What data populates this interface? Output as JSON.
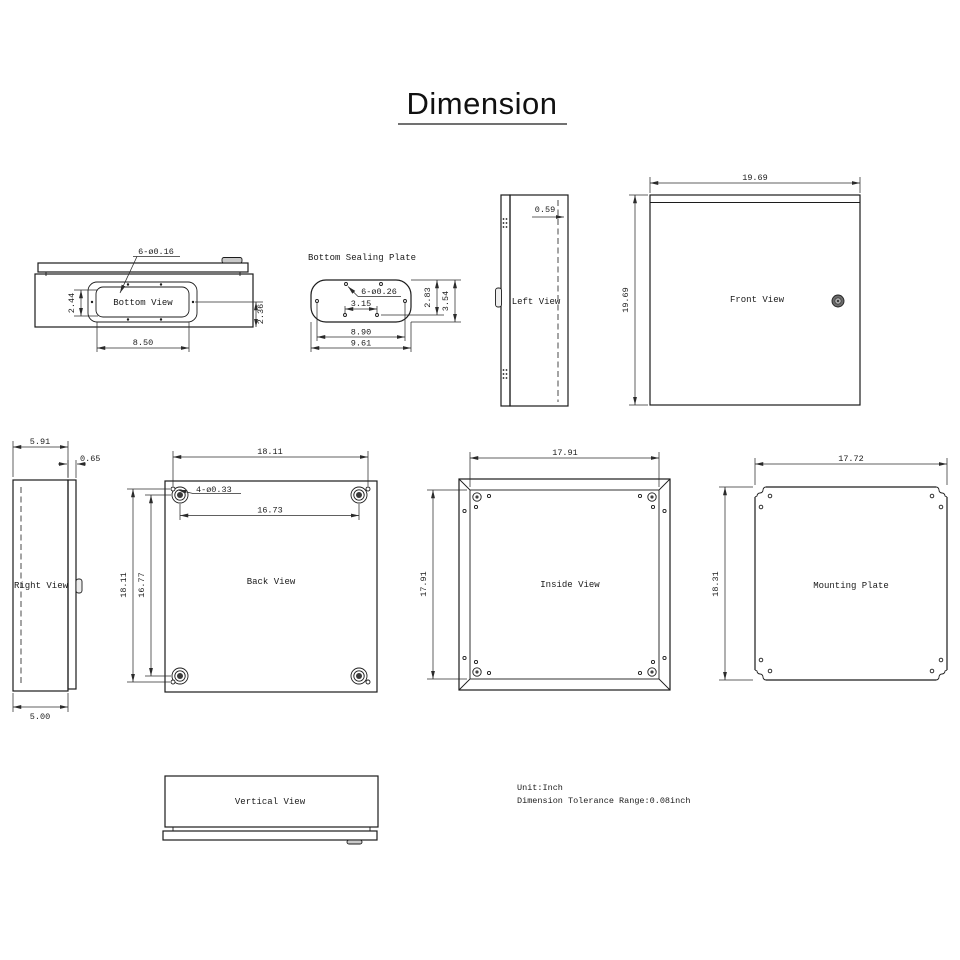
{
  "title": "Dimension",
  "notes": {
    "unit": "Unit:Inch",
    "tolerance": "Dimension Tolerance Range:0.08inch"
  },
  "views": {
    "bottom": {
      "label": "Bottom View",
      "dims": {
        "hole_note": "6-ø0.16",
        "inner_height": "2.44",
        "flange_height": "2.36",
        "hole_span": "8.50"
      }
    },
    "sealing": {
      "label": "Bottom Sealing Plate",
      "dims": {
        "hole_note": "6-ø0.26",
        "hole_gap": "3.15",
        "hole_span": "8.90",
        "width": "9.61",
        "inner_height": "2.83",
        "height": "3.54"
      }
    },
    "left": {
      "label": "Left View",
      "dims": {
        "door_inset": "0.59"
      }
    },
    "front": {
      "label": "Front View",
      "dims": {
        "width": "19.69",
        "height": "19.69"
      }
    },
    "right": {
      "label": "Right View",
      "dims": {
        "depth": "5.91",
        "door_thickness": "0.65",
        "body_depth": "5.00"
      }
    },
    "back": {
      "label": "Back View",
      "dims": {
        "hole_span_w": "18.11",
        "boss_span_w": "16.73",
        "hole_note": "4-ø0.33",
        "hole_span_h": "18.11",
        "boss_span_h": "16.77"
      }
    },
    "inside": {
      "label": "Inside View",
      "dims": {
        "width": "17.91",
        "height": "17.91"
      }
    },
    "mounting": {
      "label": "Mounting Plate",
      "dims": {
        "width": "17.72",
        "height": "18.31"
      }
    },
    "vertical": {
      "label": "Vertical View"
    }
  },
  "colors": {
    "line": "#1c1c1c",
    "background": "#ffffff"
  }
}
